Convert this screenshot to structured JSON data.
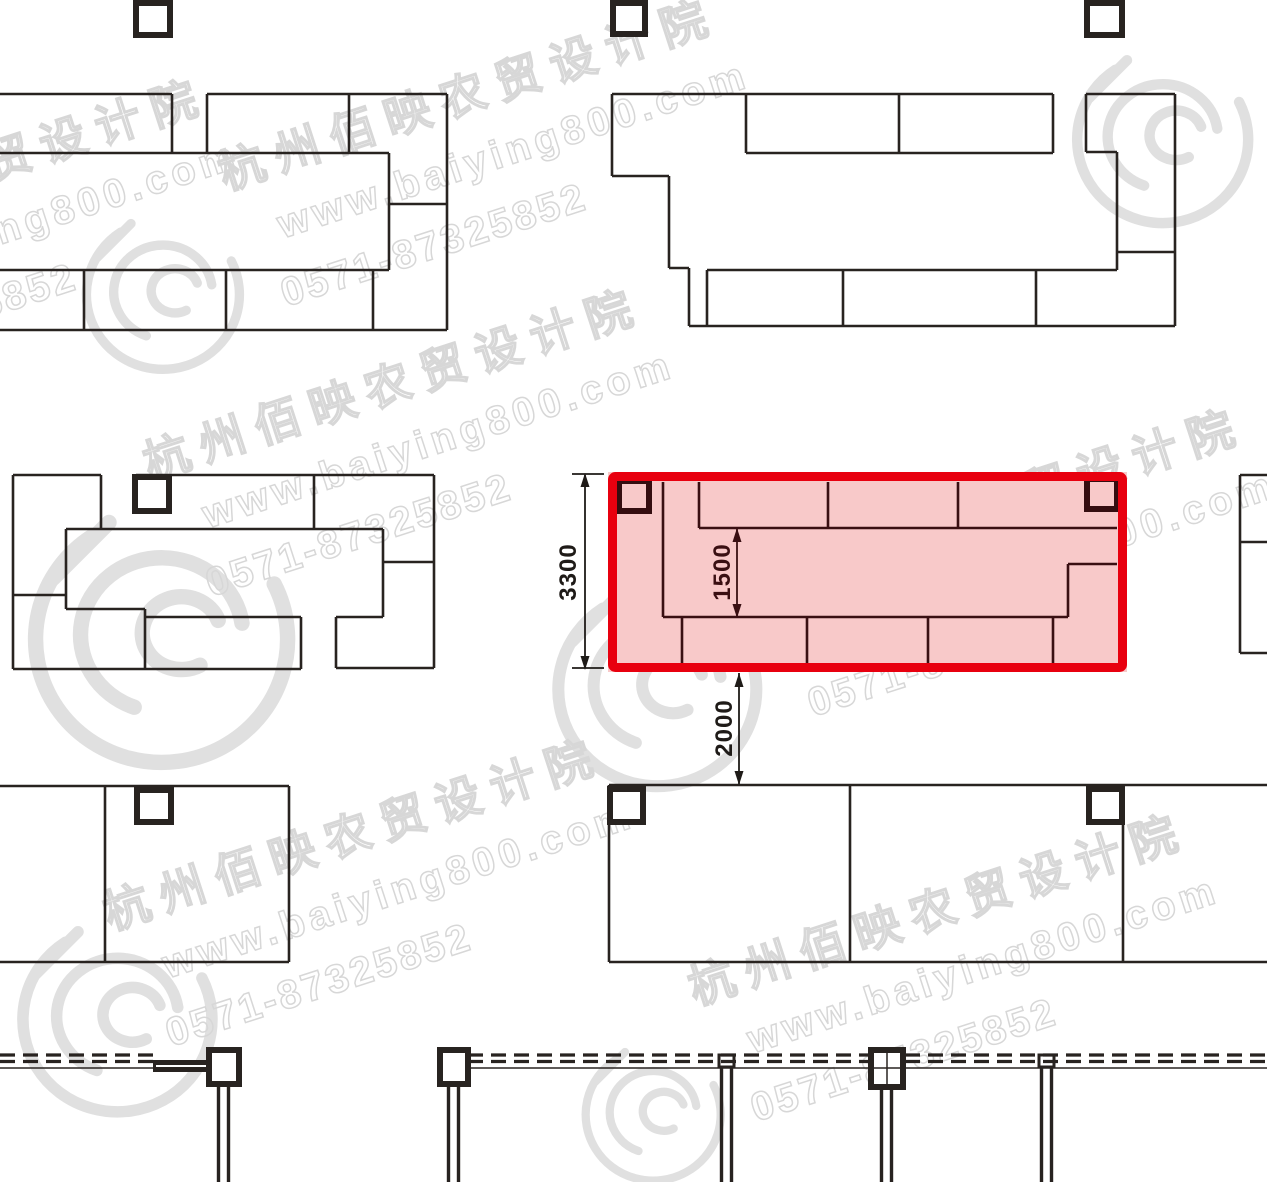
{
  "drawing": {
    "type": "market-stall-floor-plan",
    "highlight_color": "#e8000f",
    "highlight_fill": "#f8c9c9",
    "line_color": "#282320",
    "interior_line_color": "#3a0f12"
  },
  "dimensions": {
    "block_height": "3300",
    "aisle_width": "1500",
    "gap_below": "2000"
  },
  "watermark": {
    "cn": "杭州佰映农贸设计院",
    "url": "www.baiying800.com",
    "phone": "0571-87325852"
  }
}
